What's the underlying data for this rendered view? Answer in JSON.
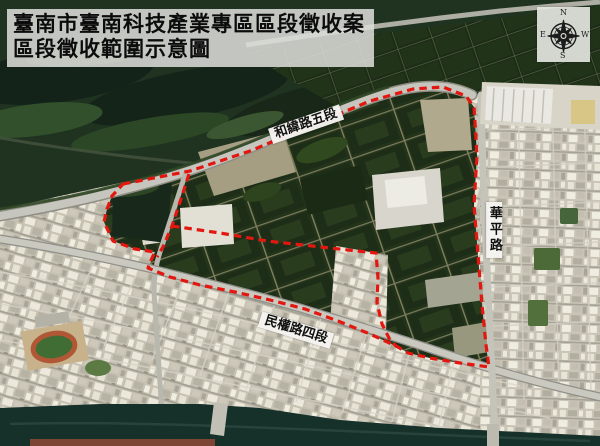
{
  "title": {
    "line1": "臺南市臺南科技產業專區區段徵收案",
    "line2": "區段徵收範圍示意圖"
  },
  "map_labels": {
    "road_top": "和緯路五段",
    "road_right": "華平路",
    "road_bottom": "民權路四段"
  },
  "compass": {
    "n": "N",
    "e": "E",
    "s": "S",
    "w": "W"
  },
  "boundary": {
    "color": "#e3170f",
    "style": "dashed"
  }
}
